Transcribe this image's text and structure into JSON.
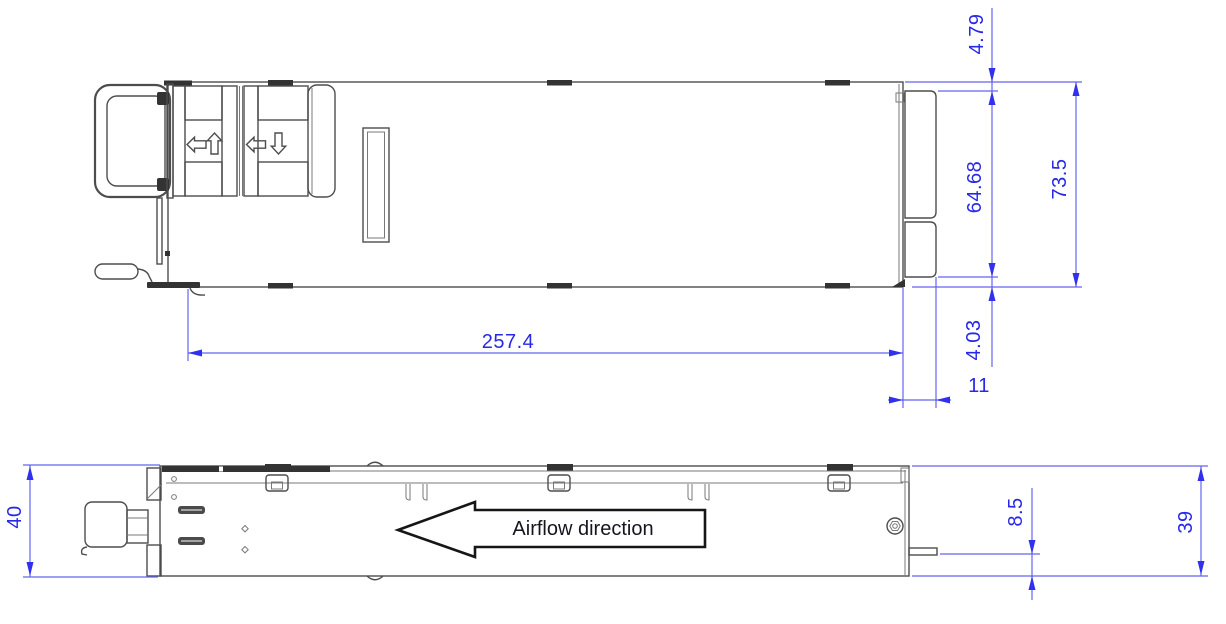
{
  "drawing": {
    "type": "mechanical-dimension-drawing",
    "views": {
      "top": {
        "dims": {
          "rear_offset_top": "4.79",
          "connector_height": "64.68",
          "overall_height": "73.5",
          "body_length": "257.4",
          "rear_offset_bottom": "4.03",
          "connector_depth": "11"
        }
      },
      "side": {
        "dims": {
          "front_height": "40",
          "tab_to_bottom": "8.5",
          "rear_height": "39"
        },
        "airflow_label": "Airflow direction"
      }
    },
    "colors": {
      "dimension_blue": "#2828e8",
      "outline_gray": "#4d4d4d",
      "airflow_text": "#15151f"
    }
  }
}
